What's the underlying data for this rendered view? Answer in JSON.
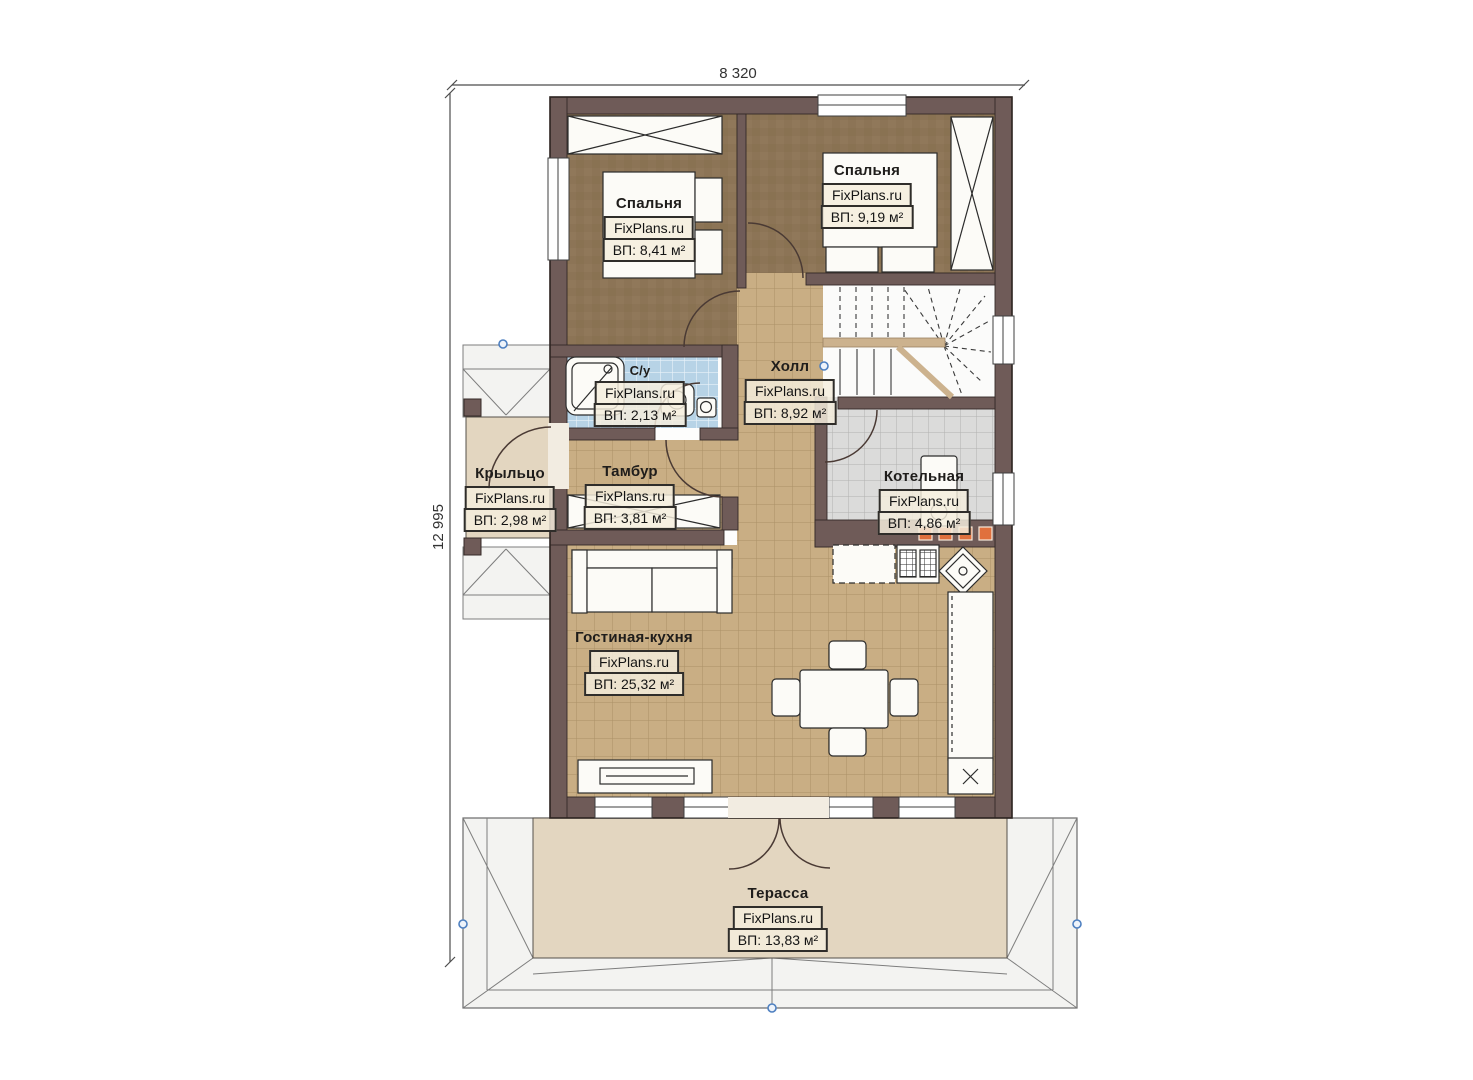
{
  "plan": {
    "dimensions": {
      "width_label": "8 320",
      "height_label": "12 995"
    },
    "watermark": "FixPlans.ru",
    "rooms": [
      {
        "key": "bedroom-left",
        "name": "Спальня",
        "area": "ВП: 8,41 м²"
      },
      {
        "key": "bedroom-right",
        "name": "Спальня",
        "area": "ВП: 9,19 м²"
      },
      {
        "key": "bathroom",
        "name": "С/у",
        "area": "ВП: 2,13 м²"
      },
      {
        "key": "hall",
        "name": "Холл",
        "area": "ВП: 8,92 м²"
      },
      {
        "key": "porch",
        "name": "Крыльцо",
        "area": "ВП: 2,98 м²"
      },
      {
        "key": "vestibule",
        "name": "Тамбур",
        "area": "ВП: 3,81 м²"
      },
      {
        "key": "boiler-room",
        "name": "Котельная",
        "area": "ВП: 4,86 м²"
      },
      {
        "key": "living-kitchen",
        "name": "Гостиная-кухня",
        "area": "ВП: 25,32 м²"
      },
      {
        "key": "terrace",
        "name": "Терасса",
        "area": "ВП: 13,83 м²"
      }
    ],
    "colors": {
      "wall": "#6f5b58",
      "carpet": "#8c7456",
      "tan_tile": "#c9ae84",
      "blue_tile": "#b7d3e6",
      "gray_tile": "#dbdbda",
      "beige": "#e3d6c0",
      "roof": "#f3f3f1",
      "fireplace_orange": "#e0703d",
      "marker_blue": "#4d7fc0"
    }
  }
}
